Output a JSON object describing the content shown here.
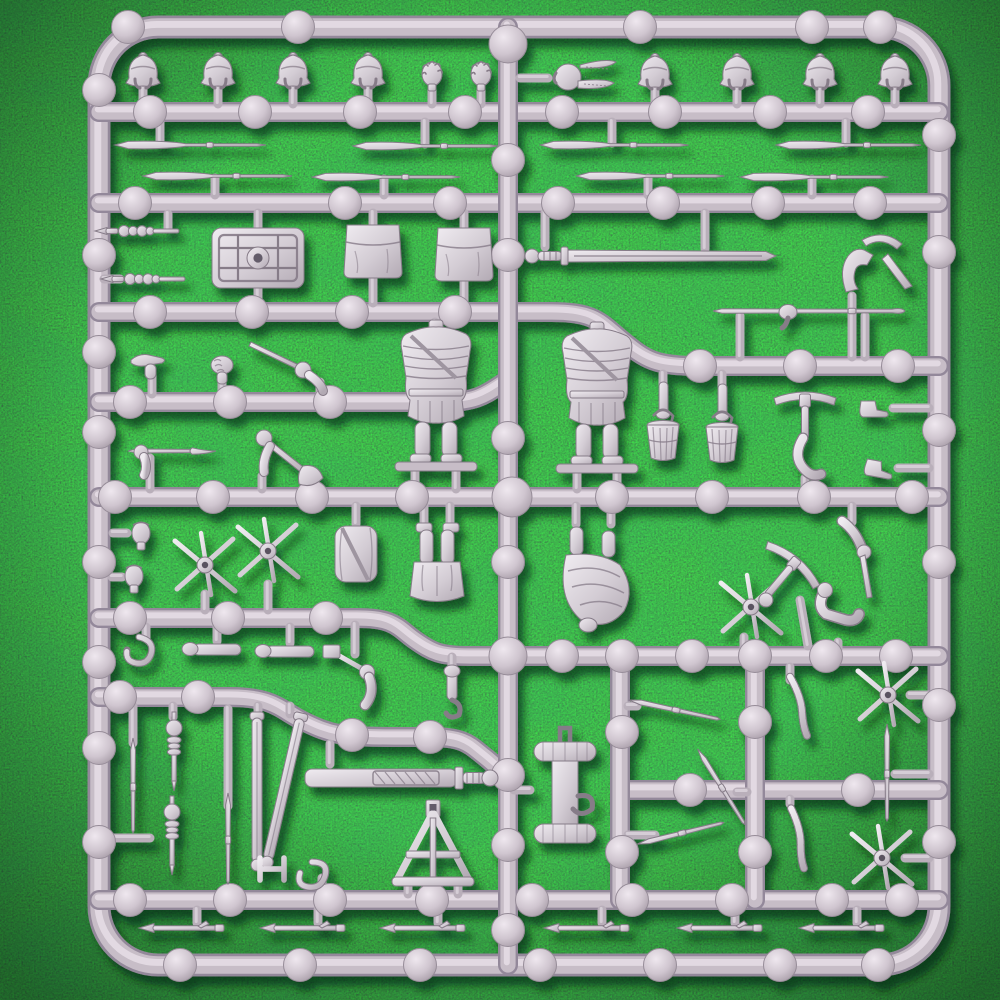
{
  "scene": {
    "description": "Grey plastic model sprue of Roman legionary miniature parts photographed on a green artificial grass mat",
    "object": "injection moulded plastic sprue",
    "background": "dark green artificial grass",
    "inventory": "crested helmets, bare heads, centurion plumed helmet, pila spears, pilum heads, scutum shield, satchel pouches, gladius swords, armoured torsos, legs, arms with tools, buckets, palisade stake crosses, scabbards, entrenching tool carrier, A-frame stand, ropes, tent pegs"
  },
  "colors": {
    "grass_base": "#1c5029",
    "grass_dark": "#0c2c16",
    "grass_light": "#3f8a4a",
    "sprue_dark": "#93889a",
    "sprue_mid": "#c7bdc7",
    "sprue_light": "#e6dee6",
    "part_light": "#f0ecf1",
    "part_dark": "#b2a9b3",
    "part_stroke": "#867b88",
    "shadow": "#06220f"
  },
  "sprue": {
    "frame": "M158 27 H880 A59 59 0 0 1 939 86 V906 A59 59 0 0 1 880 965 H158 A59 59 0 0 1 99 906 V86 A59 59 0 0 1 158 27 Z",
    "runners": [
      "M99 112 H939",
      "M99 203 H939",
      "M99 312 H552 C595 312 600 322 622 340 C646 360 655 366 700 366 H939",
      "M99 402 H445 C480 402 488 392 508 380",
      "M99 497 H939",
      "M99 618 H358 C395 618 398 628 415 640 C432 652 440 656 470 656 H939",
      "M99 697 H230 C275 697 280 710 305 722 C330 734 340 737 395 737 H430 C465 737 470 745 484 756 C497 766 500 772 508 772",
      "M620 790 H939",
      "M99 900 H939",
      "M508 27 V965",
      "M620 656 V900",
      "M755 656 V900"
    ],
    "nodes": [
      [
        128,
        27
      ],
      [
        298,
        27
      ],
      [
        640,
        27
      ],
      [
        812,
        27
      ],
      [
        880,
        27
      ],
      [
        508,
        44,
        19
      ],
      [
        150,
        112
      ],
      [
        255,
        112
      ],
      [
        360,
        112
      ],
      [
        465,
        112
      ],
      [
        562,
        112
      ],
      [
        665,
        112
      ],
      [
        770,
        112
      ],
      [
        868,
        112
      ],
      [
        99,
        90
      ],
      [
        99,
        255
      ],
      [
        99,
        352
      ],
      [
        99,
        432
      ],
      [
        99,
        562
      ],
      [
        99,
        662
      ],
      [
        99,
        748
      ],
      [
        99,
        842
      ],
      [
        939,
        135
      ],
      [
        939,
        252
      ],
      [
        939,
        430
      ],
      [
        939,
        562
      ],
      [
        939,
        705
      ],
      [
        939,
        842
      ],
      [
        135,
        203
      ],
      [
        345,
        203
      ],
      [
        450,
        203
      ],
      [
        558,
        203
      ],
      [
        663,
        203
      ],
      [
        768,
        203
      ],
      [
        870,
        203
      ],
      [
        150,
        312
      ],
      [
        252,
        312
      ],
      [
        352,
        312
      ],
      [
        455,
        312
      ],
      [
        700,
        366
      ],
      [
        800,
        366
      ],
      [
        898,
        366
      ],
      [
        130,
        402
      ],
      [
        230,
        402
      ],
      [
        330,
        402
      ],
      [
        428,
        402
      ],
      [
        115,
        497
      ],
      [
        213,
        497
      ],
      [
        312,
        497
      ],
      [
        412,
        497
      ],
      [
        512,
        497,
        20
      ],
      [
        612,
        497
      ],
      [
        712,
        497
      ],
      [
        814,
        497
      ],
      [
        912,
        497
      ],
      [
        508,
        160
      ],
      [
        508,
        255
      ],
      [
        508,
        438
      ],
      [
        508,
        562
      ],
      [
        508,
        656,
        19
      ],
      [
        508,
        775
      ],
      [
        508,
        845
      ],
      [
        508,
        930
      ],
      [
        130,
        618
      ],
      [
        228,
        618
      ],
      [
        326,
        618
      ],
      [
        562,
        656
      ],
      [
        622,
        656
      ],
      [
        692,
        656
      ],
      [
        755,
        656
      ],
      [
        826,
        656
      ],
      [
        896,
        656
      ],
      [
        120,
        697
      ],
      [
        198,
        697
      ],
      [
        352,
        735
      ],
      [
        430,
        737
      ],
      [
        622,
        732
      ],
      [
        622,
        852
      ],
      [
        755,
        722
      ],
      [
        755,
        852
      ],
      [
        690,
        790
      ],
      [
        858,
        790
      ],
      [
        130,
        900
      ],
      [
        230,
        900
      ],
      [
        330,
        900
      ],
      [
        432,
        900
      ],
      [
        532,
        900
      ],
      [
        632,
        900
      ],
      [
        732,
        900
      ],
      [
        832,
        900
      ],
      [
        902,
        900
      ],
      [
        180,
        965
      ],
      [
        300,
        965
      ],
      [
        420,
        965
      ],
      [
        540,
        965
      ],
      [
        660,
        965
      ],
      [
        780,
        965
      ],
      [
        878,
        965
      ]
    ],
    "stubs": [
      [
        143,
        88,
        143,
        104
      ],
      [
        218,
        86,
        218,
        104
      ],
      [
        293,
        86,
        293,
        104
      ],
      [
        368,
        86,
        368,
        104
      ],
      [
        432,
        86,
        432,
        104
      ],
      [
        481,
        86,
        481,
        104
      ],
      [
        655,
        88,
        655,
        104
      ],
      [
        737,
        88,
        737,
        104
      ],
      [
        820,
        88,
        820,
        104
      ],
      [
        895,
        88,
        895,
        104
      ],
      [
        520,
        78,
        548,
        78
      ],
      [
        160,
        122,
        160,
        143
      ],
      [
        425,
        122,
        425,
        144
      ],
      [
        612,
        122,
        612,
        143
      ],
      [
        846,
        122,
        846,
        143
      ],
      [
        215,
        178,
        215,
        195
      ],
      [
        384,
        179,
        384,
        195
      ],
      [
        648,
        178,
        648,
        195
      ],
      [
        812,
        179,
        812,
        195
      ],
      [
        168,
        214,
        168,
        229
      ],
      [
        104,
        279,
        120,
        279
      ],
      [
        258,
        213,
        258,
        229
      ],
      [
        258,
        287,
        258,
        303
      ],
      [
        373,
        213,
        373,
        228
      ],
      [
        373,
        276,
        373,
        303
      ],
      [
        464,
        213,
        464,
        230
      ],
      [
        464,
        281,
        464,
        303
      ],
      [
        545,
        213,
        545,
        247
      ],
      [
        705,
        213,
        705,
        249
      ],
      [
        852,
        296,
        852,
        357
      ],
      [
        435,
        322,
        435,
        336
      ],
      [
        415,
        468,
        415,
        489
      ],
      [
        456,
        468,
        456,
        489
      ],
      [
        597,
        330,
        597,
        342
      ],
      [
        577,
        468,
        577,
        489
      ],
      [
        617,
        468,
        617,
        489
      ],
      [
        740,
        316,
        740,
        357
      ],
      [
        865,
        316,
        865,
        357
      ],
      [
        152,
        374,
        152,
        394
      ],
      [
        222,
        375,
        222,
        394
      ],
      [
        320,
        382,
        320,
        394
      ],
      [
        663,
        374,
        663,
        386
      ],
      [
        722,
        374,
        722,
        386
      ],
      [
        805,
        478,
        805,
        489
      ],
      [
        893,
        408,
        929,
        408
      ],
      [
        898,
        468,
        929,
        468
      ],
      [
        150,
        458,
        150,
        489
      ],
      [
        262,
        476,
        262,
        489
      ],
      [
        113,
        533,
        127,
        533
      ],
      [
        112,
        577,
        122,
        577
      ],
      [
        205,
        594,
        205,
        610
      ],
      [
        268,
        584,
        268,
        610
      ],
      [
        356,
        506,
        356,
        524
      ],
      [
        424,
        506,
        424,
        524
      ],
      [
        450,
        506,
        450,
        524
      ],
      [
        576,
        506,
        576,
        524
      ],
      [
        611,
        506,
        611,
        524
      ],
      [
        744,
        637,
        744,
        649
      ],
      [
        800,
        600,
        808,
        646
      ],
      [
        852,
        506,
        852,
        522
      ],
      [
        838,
        642,
        838,
        649
      ],
      [
        217,
        627,
        217,
        641
      ],
      [
        290,
        627,
        290,
        643
      ],
      [
        146,
        627,
        146,
        638
      ],
      [
        355,
        625,
        355,
        654
      ],
      [
        452,
        657,
        452,
        668
      ],
      [
        133,
        743,
        133,
        706
      ],
      [
        173,
        717,
        173,
        706
      ],
      [
        258,
        714,
        258,
        706
      ],
      [
        290,
        714,
        290,
        706
      ],
      [
        228,
        806,
        228,
        709
      ],
      [
        109,
        838,
        150,
        838
      ],
      [
        322,
        878,
        322,
        892
      ],
      [
        330,
        744,
        330,
        764
      ],
      [
        490,
        778,
        502,
        778
      ],
      [
        530,
        790,
        514,
        790
      ],
      [
        408,
        884,
        408,
        894
      ],
      [
        458,
        884,
        458,
        894
      ],
      [
        790,
        680,
        790,
        667
      ],
      [
        790,
        804,
        790,
        799
      ],
      [
        637,
        706,
        628,
        706
      ],
      [
        737,
        792,
        747,
        792
      ],
      [
        655,
        835,
        628,
        835
      ],
      [
        895,
        774,
        929,
        774
      ],
      [
        910,
        695,
        929,
        695
      ],
      [
        905,
        858,
        929,
        858
      ],
      [
        197,
        910,
        197,
        923
      ],
      [
        318,
        910,
        318,
        923
      ],
      [
        438,
        910,
        438,
        923
      ],
      [
        602,
        910,
        602,
        923
      ],
      [
        735,
        910,
        735,
        923
      ],
      [
        857,
        910,
        857,
        923
      ]
    ],
    "parts": [
      {
        "t": "helm",
        "x": 143,
        "y": 72
      },
      {
        "t": "helm",
        "x": 218,
        "y": 72
      },
      {
        "t": "helm",
        "x": 293,
        "y": 72
      },
      {
        "t": "helm",
        "x": 368,
        "y": 72
      },
      {
        "t": "headcurl",
        "x": 432,
        "y": 74
      },
      {
        "t": "headcurl",
        "x": 481,
        "y": 74
      },
      {
        "t": "plumehelm",
        "x": 578,
        "y": 77
      },
      {
        "t": "helm",
        "x": 655,
        "y": 73
      },
      {
        "t": "helm",
        "x": 737,
        "y": 73
      },
      {
        "t": "helm",
        "x": 820,
        "y": 73
      },
      {
        "t": "helm",
        "x": 895,
        "y": 73
      },
      {
        "t": "spear",
        "x": 188,
        "y": 145,
        "l": 146
      },
      {
        "t": "spear",
        "x": 423,
        "y": 146,
        "l": 140
      },
      {
        "t": "spear",
        "x": 612,
        "y": 145,
        "l": 143
      },
      {
        "t": "spear",
        "x": 846,
        "y": 145,
        "l": 140
      },
      {
        "t": "spear",
        "x": 215,
        "y": 176,
        "l": 144
      },
      {
        "t": "spear",
        "x": 384,
        "y": 177,
        "l": 143
      },
      {
        "t": "spear",
        "x": 648,
        "y": 176,
        "l": 143
      },
      {
        "t": "spear",
        "x": 812,
        "y": 177,
        "l": 143
      },
      {
        "t": "pilumhead",
        "x": 137,
        "y": 231
      },
      {
        "t": "pilumhead",
        "x": 143,
        "y": 279
      },
      {
        "t": "scutum",
        "x": 258,
        "y": 258
      },
      {
        "t": "pouch",
        "x": 373,
        "y": 251
      },
      {
        "t": "pouch",
        "x": 464,
        "y": 254
      },
      {
        "t": "longsword",
        "x": 652,
        "y": 256
      },
      {
        "t": "pickarm",
        "x": 862,
        "y": 262
      },
      {
        "t": "torso",
        "x": 436,
        "y": 398
      },
      {
        "t": "torso",
        "x": 597,
        "y": 400
      },
      {
        "t": "spearh",
        "x": 808,
        "y": 311
      },
      {
        "t": "pointhand",
        "x": 152,
        "y": 363
      },
      {
        "t": "fist",
        "x": 222,
        "y": 365
      },
      {
        "t": "swordarm",
        "x": 293,
        "y": 363
      },
      {
        "t": "bucketarm",
        "x": 663,
        "y": 428
      },
      {
        "t": "bucketarm",
        "x": 722,
        "y": 430
      },
      {
        "t": "pickaxearm",
        "x": 805,
        "y": 436
      },
      {
        "t": "boot",
        "x": 873,
        "y": 408
      },
      {
        "t": "boot",
        "x": 878,
        "y": 468,
        "r": 10
      },
      {
        "t": "speararm",
        "x": 172,
        "y": 451
      },
      {
        "t": "axearm",
        "x": 290,
        "y": 458
      },
      {
        "t": "headbare",
        "x": 141,
        "y": 533
      },
      {
        "t": "headbare",
        "x": 134,
        "y": 576
      },
      {
        "t": "stakecross",
        "x": 205,
        "y": 565
      },
      {
        "t": "stakecross",
        "x": 268,
        "y": 551
      },
      {
        "t": "stakecross",
        "x": 751,
        "y": 607
      },
      {
        "t": "stakecross",
        "x": 888,
        "y": 695
      },
      {
        "t": "stakecross",
        "x": 882,
        "y": 858
      },
      {
        "t": "legsinv",
        "x": 437,
        "y": 570
      },
      {
        "t": "digger",
        "x": 594,
        "y": 589
      },
      {
        "t": "packroll",
        "x": 356,
        "y": 554
      },
      {
        "t": "forearm",
        "x": 217,
        "y": 649
      },
      {
        "t": "forearm",
        "x": 290,
        "y": 651
      },
      {
        "t": "hornrope",
        "x": 146,
        "y": 664
      },
      {
        "t": "hammerarm",
        "x": 356,
        "y": 681
      },
      {
        "t": "toolhand",
        "x": 452,
        "y": 691
      },
      {
        "t": "pickaxed",
        "x": 790,
        "y": 568,
        "r": 40
      },
      {
        "t": "armstake",
        "x": 856,
        "y": 549
      },
      {
        "t": "armbent",
        "x": 840,
        "y": 608
      },
      {
        "t": "javelin",
        "x": 133,
        "y": 787,
        "r": 90,
        "l": 86
      },
      {
        "t": "javelin",
        "x": 228,
        "y": 840,
        "r": 90,
        "l": 82
      },
      {
        "t": "javelin",
        "x": 887,
        "y": 774,
        "r": 90,
        "l": 88
      },
      {
        "t": "javelin",
        "x": 676,
        "y": 710,
        "r": 12,
        "l": 84
      },
      {
        "t": "javelin",
        "x": 722,
        "y": 788,
        "r": 58,
        "l": 80
      },
      {
        "t": "javelin",
        "x": 682,
        "y": 833,
        "r": -14,
        "l": 80
      },
      {
        "t": "pilumv",
        "x": 174,
        "y": 754
      },
      {
        "t": "pilumv",
        "x": 172,
        "y": 838
      },
      {
        "t": "scabbard",
        "x": 257,
        "y": 790
      },
      {
        "t": "scabbard",
        "x": 284,
        "y": 789,
        "r": 13
      },
      {
        "t": "buckle",
        "x": 272,
        "y": 869
      },
      {
        "t": "shook",
        "x": 321,
        "y": 884
      },
      {
        "t": "sheathsword",
        "x": 397,
        "y": 778
      },
      {
        "t": "toolcarrier",
        "x": 565,
        "y": 794
      },
      {
        "t": "aframe",
        "x": 433,
        "y": 848
      },
      {
        "t": "rope",
        "x": 797,
        "y": 706,
        "r": 8
      },
      {
        "t": "rope",
        "x": 796,
        "y": 838,
        "r": 12
      },
      {
        "t": "peg",
        "x": 182,
        "y": 928
      },
      {
        "t": "peg",
        "x": 303,
        "y": 928
      },
      {
        "t": "peg",
        "x": 423,
        "y": 928
      },
      {
        "t": "peg",
        "x": 587,
        "y": 928
      },
      {
        "t": "peg",
        "x": 720,
        "y": 928
      },
      {
        "t": "peg",
        "x": 842,
        "y": 928
      }
    ]
  }
}
